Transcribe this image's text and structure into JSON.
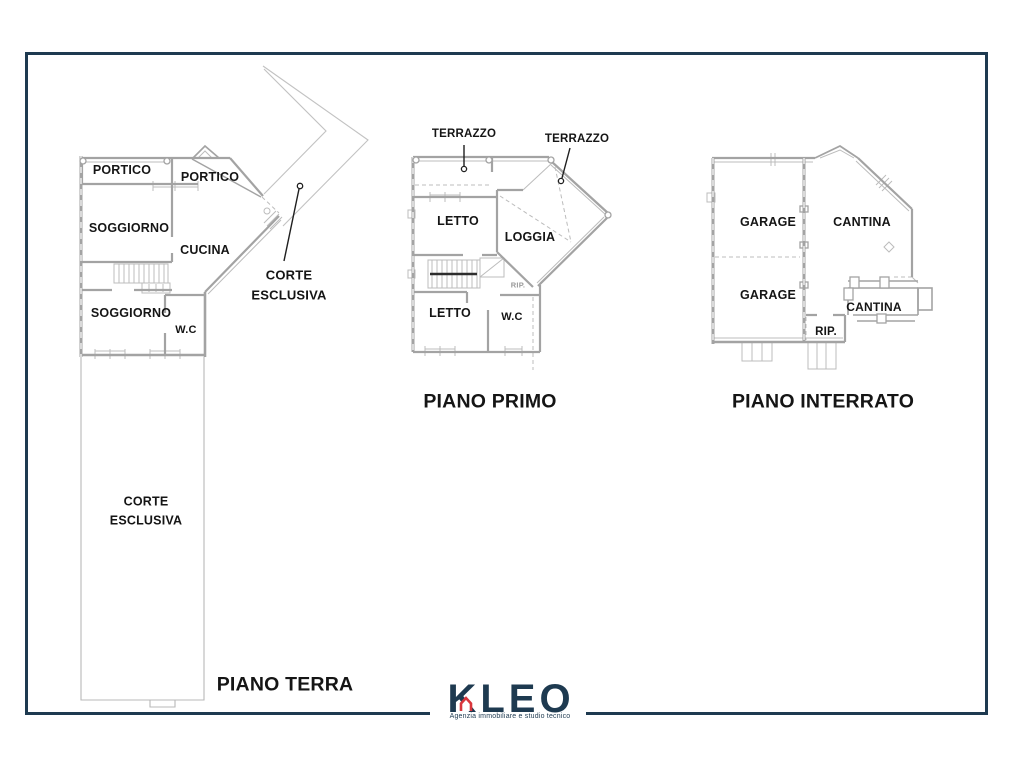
{
  "page": {
    "background": "#ffffff"
  },
  "frame": {
    "border_color": "#1e3a50"
  },
  "plans": {
    "terra": {
      "title": "PIANO TERRA",
      "rooms": {
        "portico_top": "PORTICO",
        "portico_side": "PORTICO",
        "soggiorno_upper": "SOGGIORNO",
        "cucina": "CUCINA",
        "soggiorno_lower": "SOGGIORNO",
        "wc": "W.C"
      },
      "annotations": {
        "corte_callout_line1": "CORTE",
        "corte_callout_line2": "ESCLUSIVA",
        "corte_strip_line1": "CORTE",
        "corte_strip_line2": "ESCLUSIVA"
      }
    },
    "primo": {
      "title": "PIANO PRIMO",
      "rooms": {
        "terrazzo_left": "TERRAZZO",
        "terrazzo_right": "TERRAZZO",
        "letto_upper": "LETTO",
        "loggia": "LOGGIA",
        "letto_lower": "LETTO",
        "wc": "W.C",
        "rip": "RIP."
      }
    },
    "interrato": {
      "title": "PIANO INTERRATO",
      "rooms": {
        "garage_upper": "GARAGE",
        "cantina_main": "CANTINA",
        "garage_lower": "GARAGE",
        "cantina_small": "CANTINA",
        "rip": "RIP."
      }
    }
  },
  "logo": {
    "name": "KLEO",
    "tagline": "Agenzia immobiliare e studio tecnico",
    "navy": "#1e3a50",
    "red": "#d9363c"
  },
  "colors": {
    "wall_gray": "#a3a3a3",
    "thin_gray": "#bcbcbc",
    "annotation_black": "#1f1f1f",
    "label_black": "#151515"
  }
}
